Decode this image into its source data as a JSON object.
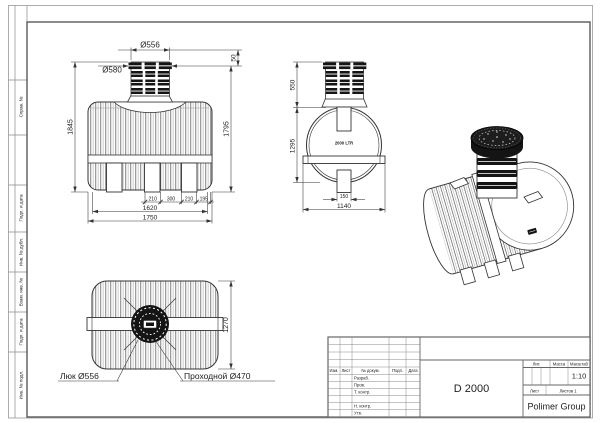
{
  "frame": {
    "side_labels": [
      "Справ. №",
      "Подп. и дата",
      "Инв. № дубл.",
      "Взам. инв. №",
      "Подп. и дата",
      "Инв. № подл."
    ]
  },
  "title_block": {
    "col_headers": [
      "Изм.",
      "Лист",
      "№ докум.",
      "Подп.",
      "Дата"
    ],
    "row_labels": [
      "Разраб.",
      "Пров.",
      "Т. контр.",
      "Н. контр.",
      "Утв."
    ],
    "stat_headers": [
      "Лит.",
      "Масса",
      "Масштаб"
    ],
    "part_title": "D 2000",
    "scale_value": "1:10",
    "sheet_label": "Лист",
    "sheets_label": "Листов 1",
    "company": "Polimer Group"
  },
  "front_view": {
    "dia_top": "Ø556",
    "dia_lid": "Ø580",
    "h_offset": "50",
    "h_total": "1845",
    "h_body": "1795",
    "w_seg1": "210",
    "w_seg2": "300",
    "w_seg3": "210",
    "w_seg4": "195",
    "w_inner": "1620",
    "w_total": "1750"
  },
  "side_view": {
    "volume": "2000 LTR",
    "h_neck": "550",
    "h_body": "1295",
    "w_tab": "150",
    "w_total": "1140"
  },
  "top_view": {
    "h_total": "1270",
    "label_manhole": "Люк Ø556",
    "label_passage": "Проходной Ø470"
  },
  "colors": {
    "line": "#333333",
    "frame": "#888888",
    "black_fill": "#141414"
  }
}
